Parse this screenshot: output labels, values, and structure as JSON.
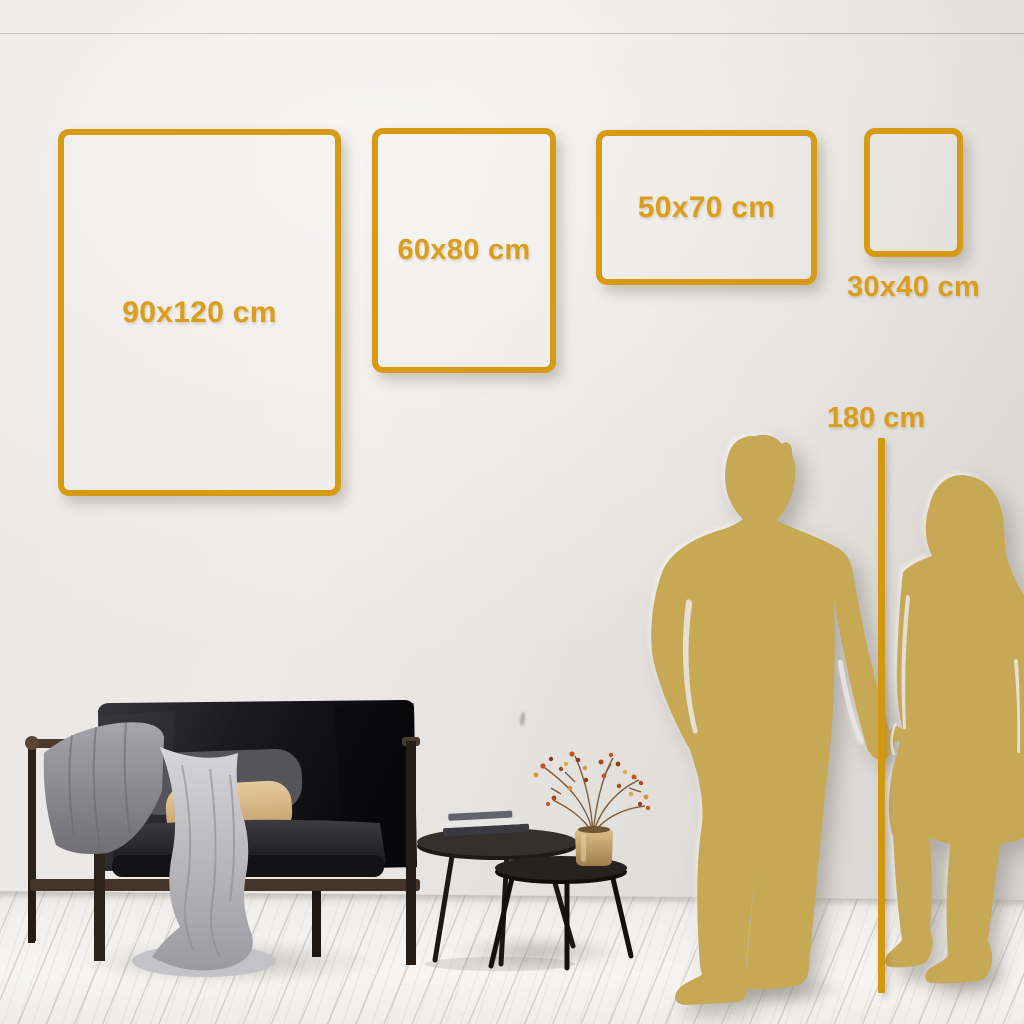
{
  "frames": [
    {
      "label": "90x120 cm"
    },
    {
      "label": "60x80 cm"
    },
    {
      "label": "50x70 cm"
    },
    {
      "label": "30x40 cm"
    }
  ],
  "reference": {
    "label": "180 cm"
  },
  "colors": {
    "gold_accent": "#D79A15",
    "gold_text": "#DA9E1C",
    "measure_line": "#D0990F",
    "silhouette_gold": "#C7A855"
  }
}
